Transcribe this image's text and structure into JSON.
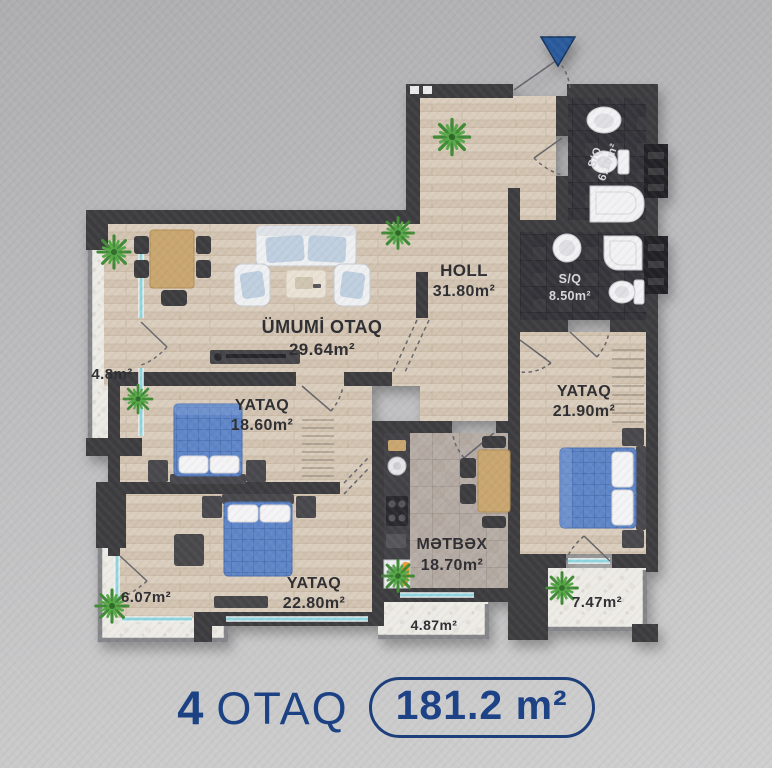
{
  "rooms": [
    {
      "id": "holl",
      "name": "HOLL",
      "area": "31.80m²"
    },
    {
      "id": "sq-top",
      "name": "S/Q",
      "area": "6.10m²"
    },
    {
      "id": "sq-mid",
      "name": "S/Q",
      "area": "8.50m²"
    },
    {
      "id": "living",
      "name": "ÜMUMİ OTAQ",
      "area": "29.64m²"
    },
    {
      "id": "balcony-left",
      "name": "",
      "area": "4.8m²"
    },
    {
      "id": "bedroom-1",
      "name": "YATAQ",
      "area": "18.60m²"
    },
    {
      "id": "bedroom-2",
      "name": "YATAQ",
      "area": "21.90m²"
    },
    {
      "id": "kitchen",
      "name": "MƏTBƏX",
      "area": "18.70m²"
    },
    {
      "id": "bedroom-3",
      "name": "YATAQ",
      "area": "22.80m²"
    },
    {
      "id": "balcony-bottom-left",
      "name": "",
      "area": "6.07m²"
    },
    {
      "id": "balcony-bottom-mid",
      "name": "",
      "area": "4.87m²"
    },
    {
      "id": "balcony-bottom-right",
      "name": "",
      "area": "7.47m²"
    }
  ],
  "footer": {
    "rooms_count": "4",
    "rooms_label": "OTAQ",
    "area_value": "181.2 m²"
  },
  "colors": {
    "accent": "#1d4284",
    "wall": "#3e3e41",
    "wood": "#d8cbbb",
    "bath_tile": "#35353b",
    "kitchen_tile": "#b6ada6",
    "balcony_stone": "#edebe6",
    "bed_blue": "#5e86c8",
    "plant_green": "#3f8a35",
    "glass": "#8fd4de",
    "label_dark": "#2d2d30",
    "label_light": "#d9d9dd"
  },
  "icons": {
    "entry_marker": "entrance-arrow-down"
  }
}
